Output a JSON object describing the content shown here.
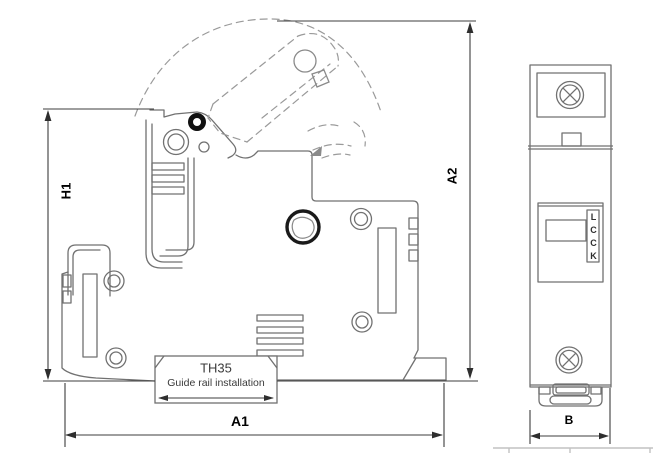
{
  "side_view": {
    "dim_height_partial": "H1",
    "dim_height_overall": "A2",
    "dim_width_overall": "A1",
    "rail": {
      "model": "TH35",
      "caption": "Guide rail installation"
    }
  },
  "front_view": {
    "dim_width": "B",
    "marking": [
      "L",
      "C",
      "C",
      "K"
    ]
  },
  "colors": {
    "body_line": "#717171",
    "dashed_line": "#9a9a9a",
    "dimension_line": "#3d3d3d",
    "label_text": "#000000",
    "accent_black": "#1a1a1a"
  }
}
